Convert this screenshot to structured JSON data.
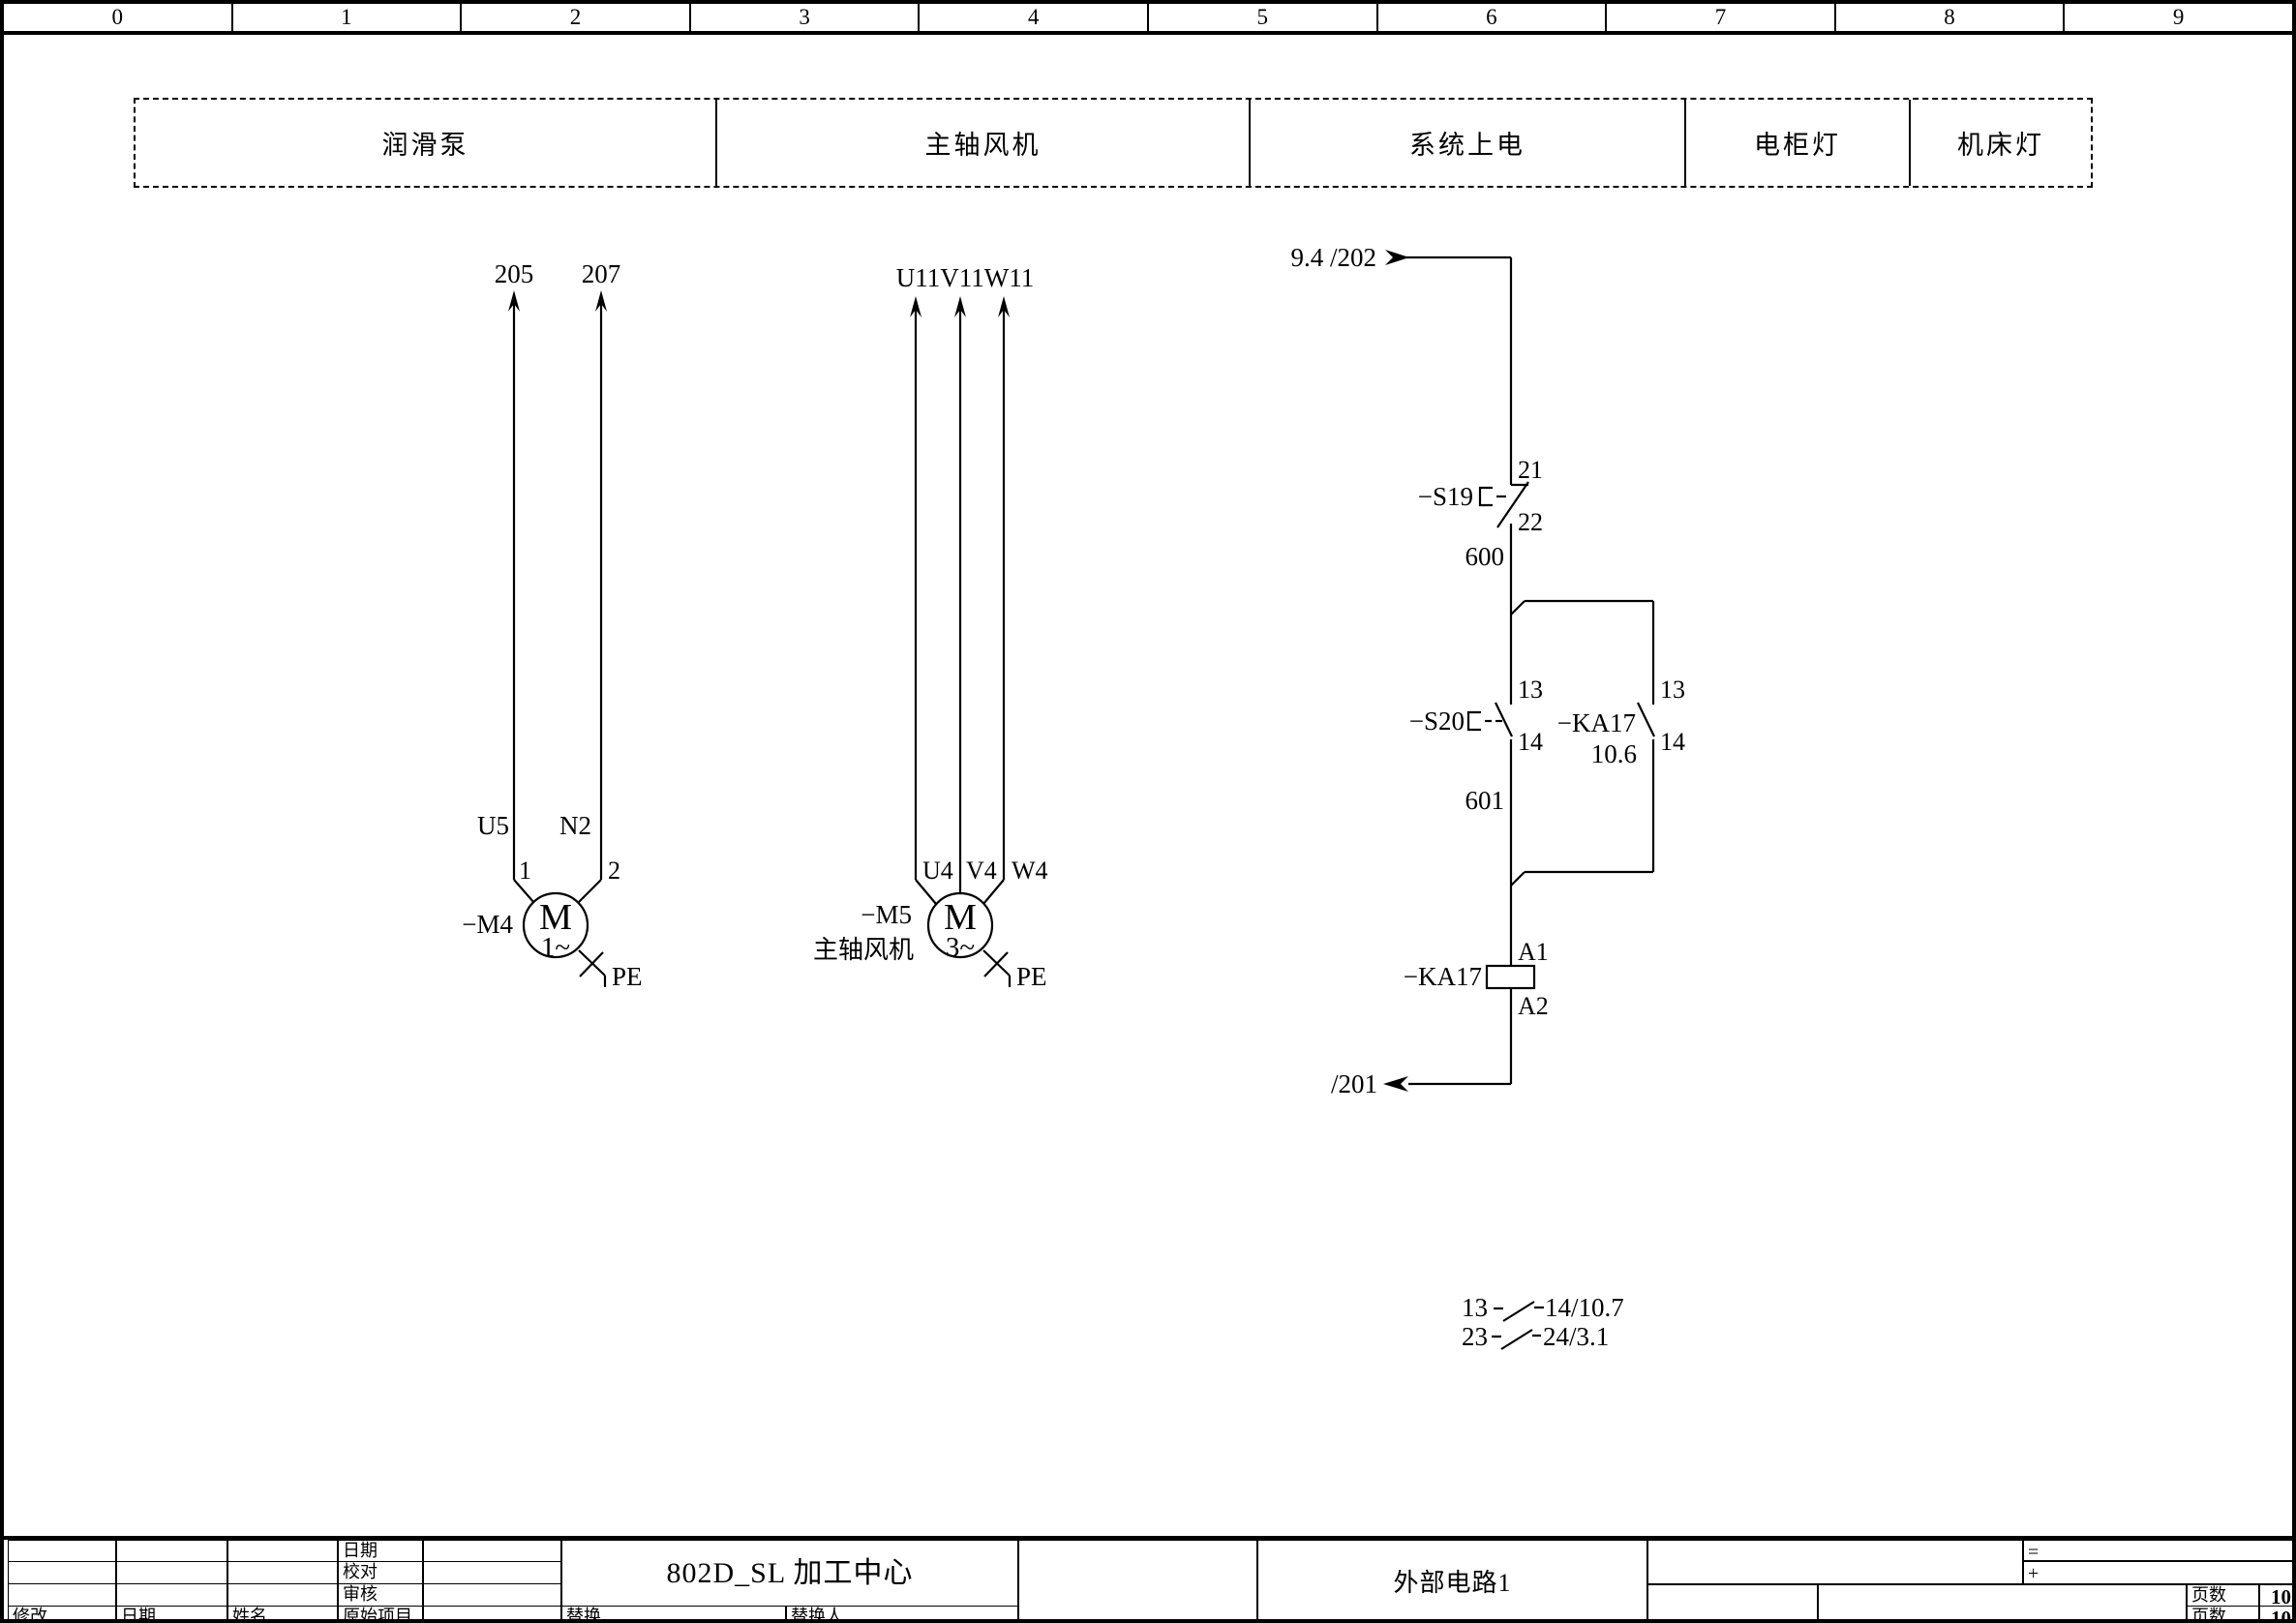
{
  "ruler": {
    "labels": [
      "0",
      "1",
      "2",
      "3",
      "4",
      "5",
      "6",
      "7",
      "8",
      "9"
    ]
  },
  "function_zones": [
    {
      "label": "润滑泵"
    },
    {
      "label": "主轴风机"
    },
    {
      "label": "系统上电"
    },
    {
      "label": "电柜灯"
    },
    {
      "label": "机床灯"
    }
  ],
  "lube_pump": {
    "wire_left": "205",
    "wire_right": "207",
    "lbl_u5": "U5",
    "lbl_n2": "N2",
    "term_1": "1",
    "term_2": "2",
    "tag": "−M4",
    "motor_letter": "M",
    "phase": "1~",
    "pe": "PE"
  },
  "spindle_fan": {
    "wires": "U11V11W11",
    "lbl_u4": "U4",
    "lbl_v4": "V4",
    "lbl_w4": "W4",
    "tag": "−M5",
    "name": "主轴风机",
    "motor_letter": "M",
    "phase": "3~",
    "pe": "PE"
  },
  "power_on": {
    "src_ref": "9.4 /202",
    "s19": {
      "tag": "−S19",
      "t_top": "21",
      "t_bot": "22"
    },
    "wire_600": "600",
    "s20": {
      "tag": "−S20",
      "t_top": "13",
      "t_bot": "14"
    },
    "ka17_contact": {
      "tag": "−KA17",
      "ref": "10.6",
      "t_top": "13",
      "t_bot": "14"
    },
    "wire_601": "601",
    "coil": {
      "t_top": "A1",
      "tag": "−KA17",
      "t_bot": "A2"
    },
    "dst_ref": "/201",
    "xref_rows": [
      {
        "from": "13",
        "to": "14/10.7"
      },
      {
        "from": "23",
        "to": "24/3.1"
      }
    ]
  },
  "title_block": {
    "row_date": "日期",
    "row_check": "校对",
    "row_audit": "审核",
    "col_modify": "修改",
    "col_date": "日期",
    "col_name": "姓名",
    "col_origin": "原始项目",
    "col_replace": "替换",
    "col_replaced_by": "替换人",
    "project": "802D_SL 加工中心",
    "sheet": "外部电路1",
    "ref_eq": "=",
    "ref_plus": "+",
    "pages_label_top": "页数",
    "pages_top": "10",
    "pages_label_bottom": "页数",
    "pages_bottom": "10"
  }
}
